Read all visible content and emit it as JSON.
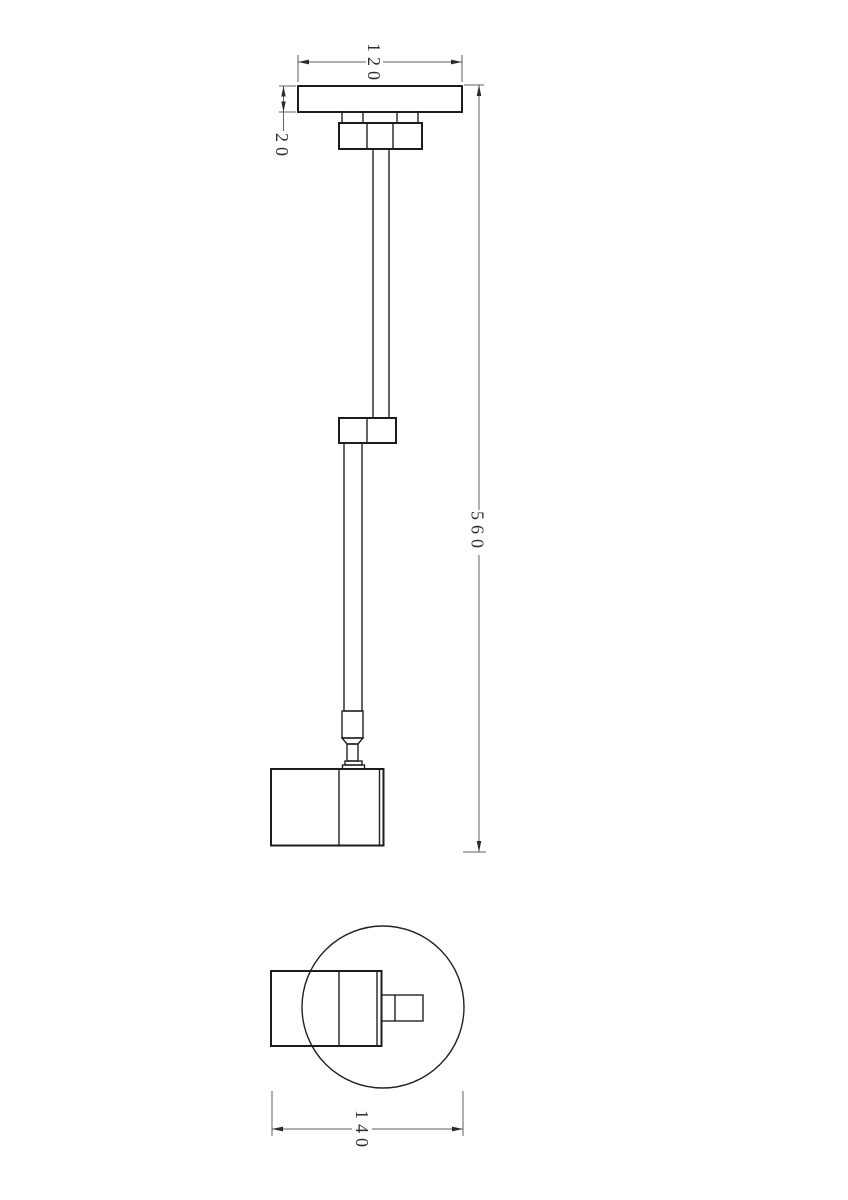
{
  "colors": {
    "background": "#ffffff",
    "object_line": "#1c1c1c",
    "dimension_line": "#616161",
    "dimension_text": "#2e2e2e"
  },
  "dims": {
    "plate_width": "120",
    "plate_thickness": "20",
    "overall_height": "560",
    "overall_width": "140"
  }
}
